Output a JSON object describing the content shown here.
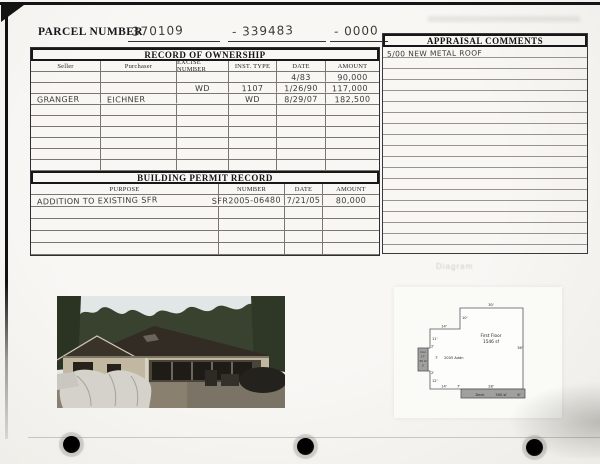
{
  "parcel": {
    "label": "PARCEL NUMBER",
    "number1": "370109",
    "number2": "- 339483",
    "number3": "- 0000"
  },
  "ownership": {
    "title": "RECORD OF OWNERSHIP",
    "columns": [
      "Seller",
      "Purchaser",
      "EXCISE NUMBER",
      "INST. TYPE",
      "DATE",
      "AMOUNT"
    ],
    "rows": [
      [
        "",
        "",
        "",
        "",
        "4/83",
        "90,000"
      ],
      [
        "",
        "",
        "WD",
        "1107",
        "1/26/90",
        "117,000"
      ],
      [
        "GRANGER",
        "EICHNER",
        "",
        "WD",
        "8/29/07",
        "182,500"
      ],
      [
        "",
        "",
        "",
        "",
        "",
        ""
      ],
      [
        "",
        "",
        "",
        "",
        "",
        ""
      ],
      [
        "",
        "",
        "",
        "",
        "",
        ""
      ],
      [
        "",
        "",
        "",
        "",
        "",
        ""
      ],
      [
        "",
        "",
        "",
        "",
        "",
        ""
      ],
      [
        "",
        "",
        "",
        "",
        "",
        ""
      ]
    ]
  },
  "permits": {
    "title": "BUILDING PERMIT RECORD",
    "columns": [
      "PURPOSE",
      "NUMBER",
      "DATE",
      "AMOUNT"
    ],
    "rows": [
      [
        "ADDITION TO EXISTING SFR",
        "SFR2005-06480",
        "7/21/05",
        "80,000"
      ],
      [
        "",
        "",
        "",
        ""
      ],
      [
        "",
        "",
        "",
        ""
      ],
      [
        "",
        "",
        "",
        ""
      ],
      [
        "",
        "",
        "",
        ""
      ]
    ]
  },
  "appraisal": {
    "title": "APPRAISAL COMMENTS",
    "note": "5/00 NEW METAL ROOF"
  },
  "diagram": {
    "ghost_label": "Diagram"
  },
  "floorplan": {
    "first_floor": "First Floor",
    "first_floor_area": "1546 sf",
    "addition": "2005 Addn",
    "deck": "Deck",
    "deck_area": "300 sf",
    "addn_box": {
      "l1": "Cov",
      "l2": "17'",
      "l3": "50 sf",
      "l4": "3'"
    },
    "dims": {
      "top": "30'",
      "step": "10'",
      "upper": "14'",
      "left_upper": "11'",
      "jog_upper": "2'",
      "addn_right": "7'",
      "jog_lower": "2'",
      "left_lower": "12'",
      "bottom": "14'",
      "bottom_jog": "7'",
      "deck_top": "28'",
      "right": "36'",
      "deck_right": "6'"
    }
  },
  "colors": {
    "paper": "#f5f4f1",
    "ink": "#17171a",
    "handwriting": "#3a3a36",
    "gray_fill": "#a0a09e"
  }
}
